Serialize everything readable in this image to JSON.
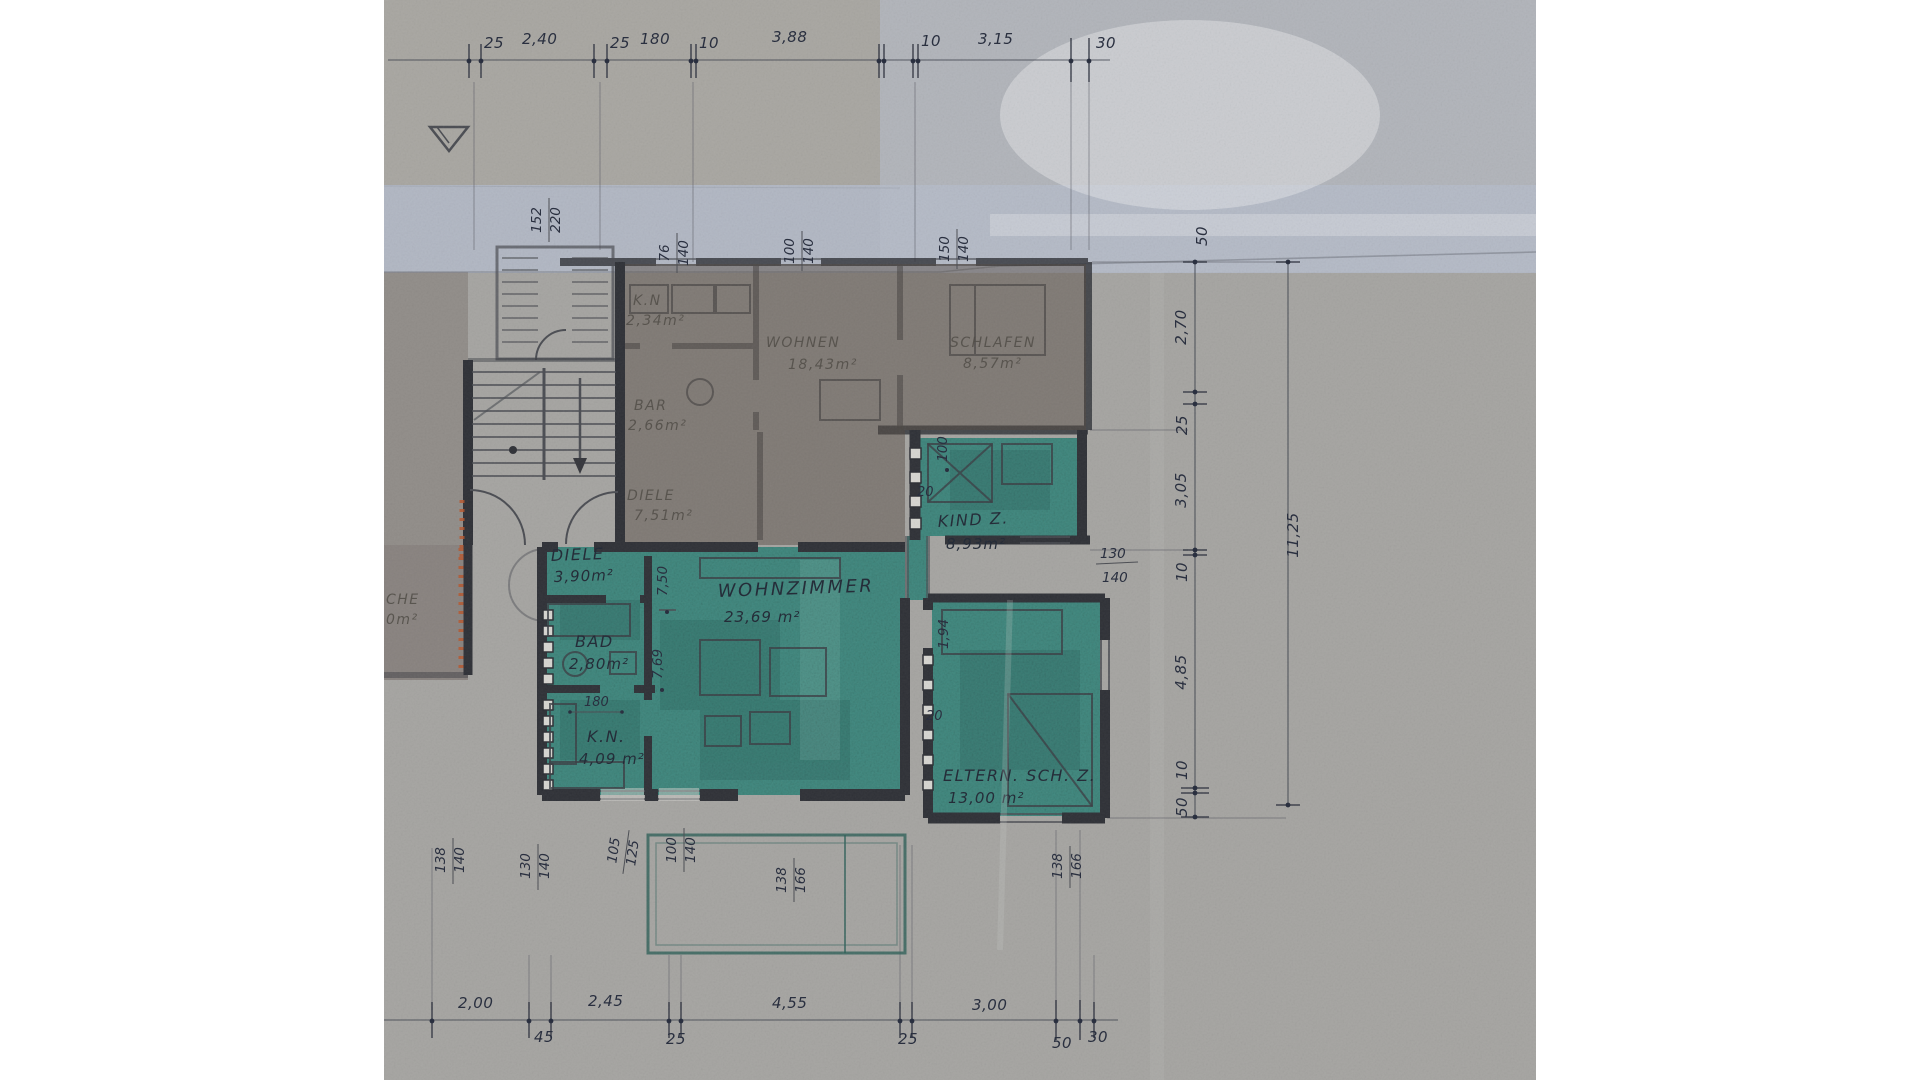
{
  "rooms": {
    "diele": {
      "name": "DIELE",
      "area": "3,90m²"
    },
    "bad": {
      "name": "BAD",
      "area": "2,80m²"
    },
    "kn": {
      "name": "K.N.",
      "area": "4,09 m²"
    },
    "wohnzimmer": {
      "name": "WOHNZIMMER",
      "area": "23,69  m²"
    },
    "kind": {
      "name": "KIND Z.",
      "area": "8,93m²"
    },
    "eltern": {
      "name": "ELTERN. SCH. Z.",
      "area": "13,00 m²"
    }
  },
  "upper_rooms": {
    "kn": {
      "name": "K.N",
      "area": "2,34m²"
    },
    "wohnen": {
      "name": "WOHNEN",
      "area": "18,43m²"
    },
    "schlafen": {
      "name": "SCHLAFEN",
      "area": "8,57m²"
    },
    "bar": {
      "name": "BAR",
      "area": "2,66m²"
    },
    "diele": {
      "name": "DIELE",
      "area": "7,51m²"
    },
    "kueche": {
      "name": "CHE",
      "area": "0m²"
    }
  },
  "dims_top": {
    "d25a": "25",
    "d240": "2,40",
    "d25b": "25",
    "d180": "180",
    "d10a": "10",
    "d388": "3,88",
    "d10b": "10",
    "d315": "3,15",
    "d30": "30"
  },
  "dims_bottom": {
    "d200": "2,00",
    "d45": "45",
    "d245": "2,45",
    "d25a": "25",
    "d455": "4,55",
    "d25b": "25",
    "d300": "3,00",
    "d50": "50",
    "d30": "30"
  },
  "dims_right": {
    "d50top": "50",
    "d270": "2,70",
    "d25": "25",
    "d305": "3,05",
    "d10a": "10",
    "d485": "4,85",
    "d10b": "10",
    "d50": "50",
    "overall": "11,25"
  },
  "windows": {
    "porch": {
      "w": "152",
      "h": "220"
    },
    "top1": {
      "w": "76",
      "h": "140"
    },
    "top2": {
      "w": "100",
      "h": "140"
    },
    "top3": {
      "w": "150",
      "h": "140"
    },
    "kind_right": {
      "w": "130",
      "h": "140"
    },
    "bottom1": {
      "w": "138",
      "h": "140"
    },
    "bottom2": {
      "w": "130",
      "h": "140"
    },
    "bottom3": {
      "w": "105",
      "h": "125"
    },
    "bottom4": {
      "w": "100",
      "h": "140"
    },
    "balcony_door": {
      "w": "138",
      "h": "166"
    },
    "eltern_bottom": {
      "w": "138",
      "h": "166"
    }
  },
  "annotations": {
    "v100": "100",
    "v194": "1,94",
    "d20a": "20",
    "d20b": "20",
    "v750": "7,50",
    "v769": "7,69",
    "d180": "180"
  },
  "colors": {
    "paper": "#a6a5a2",
    "tape_band": "#b2b8c4",
    "room_highlight": "#3f8a80",
    "pencil": "#2e3036",
    "ink": "#232838",
    "orange_marks": "#b9552b"
  }
}
